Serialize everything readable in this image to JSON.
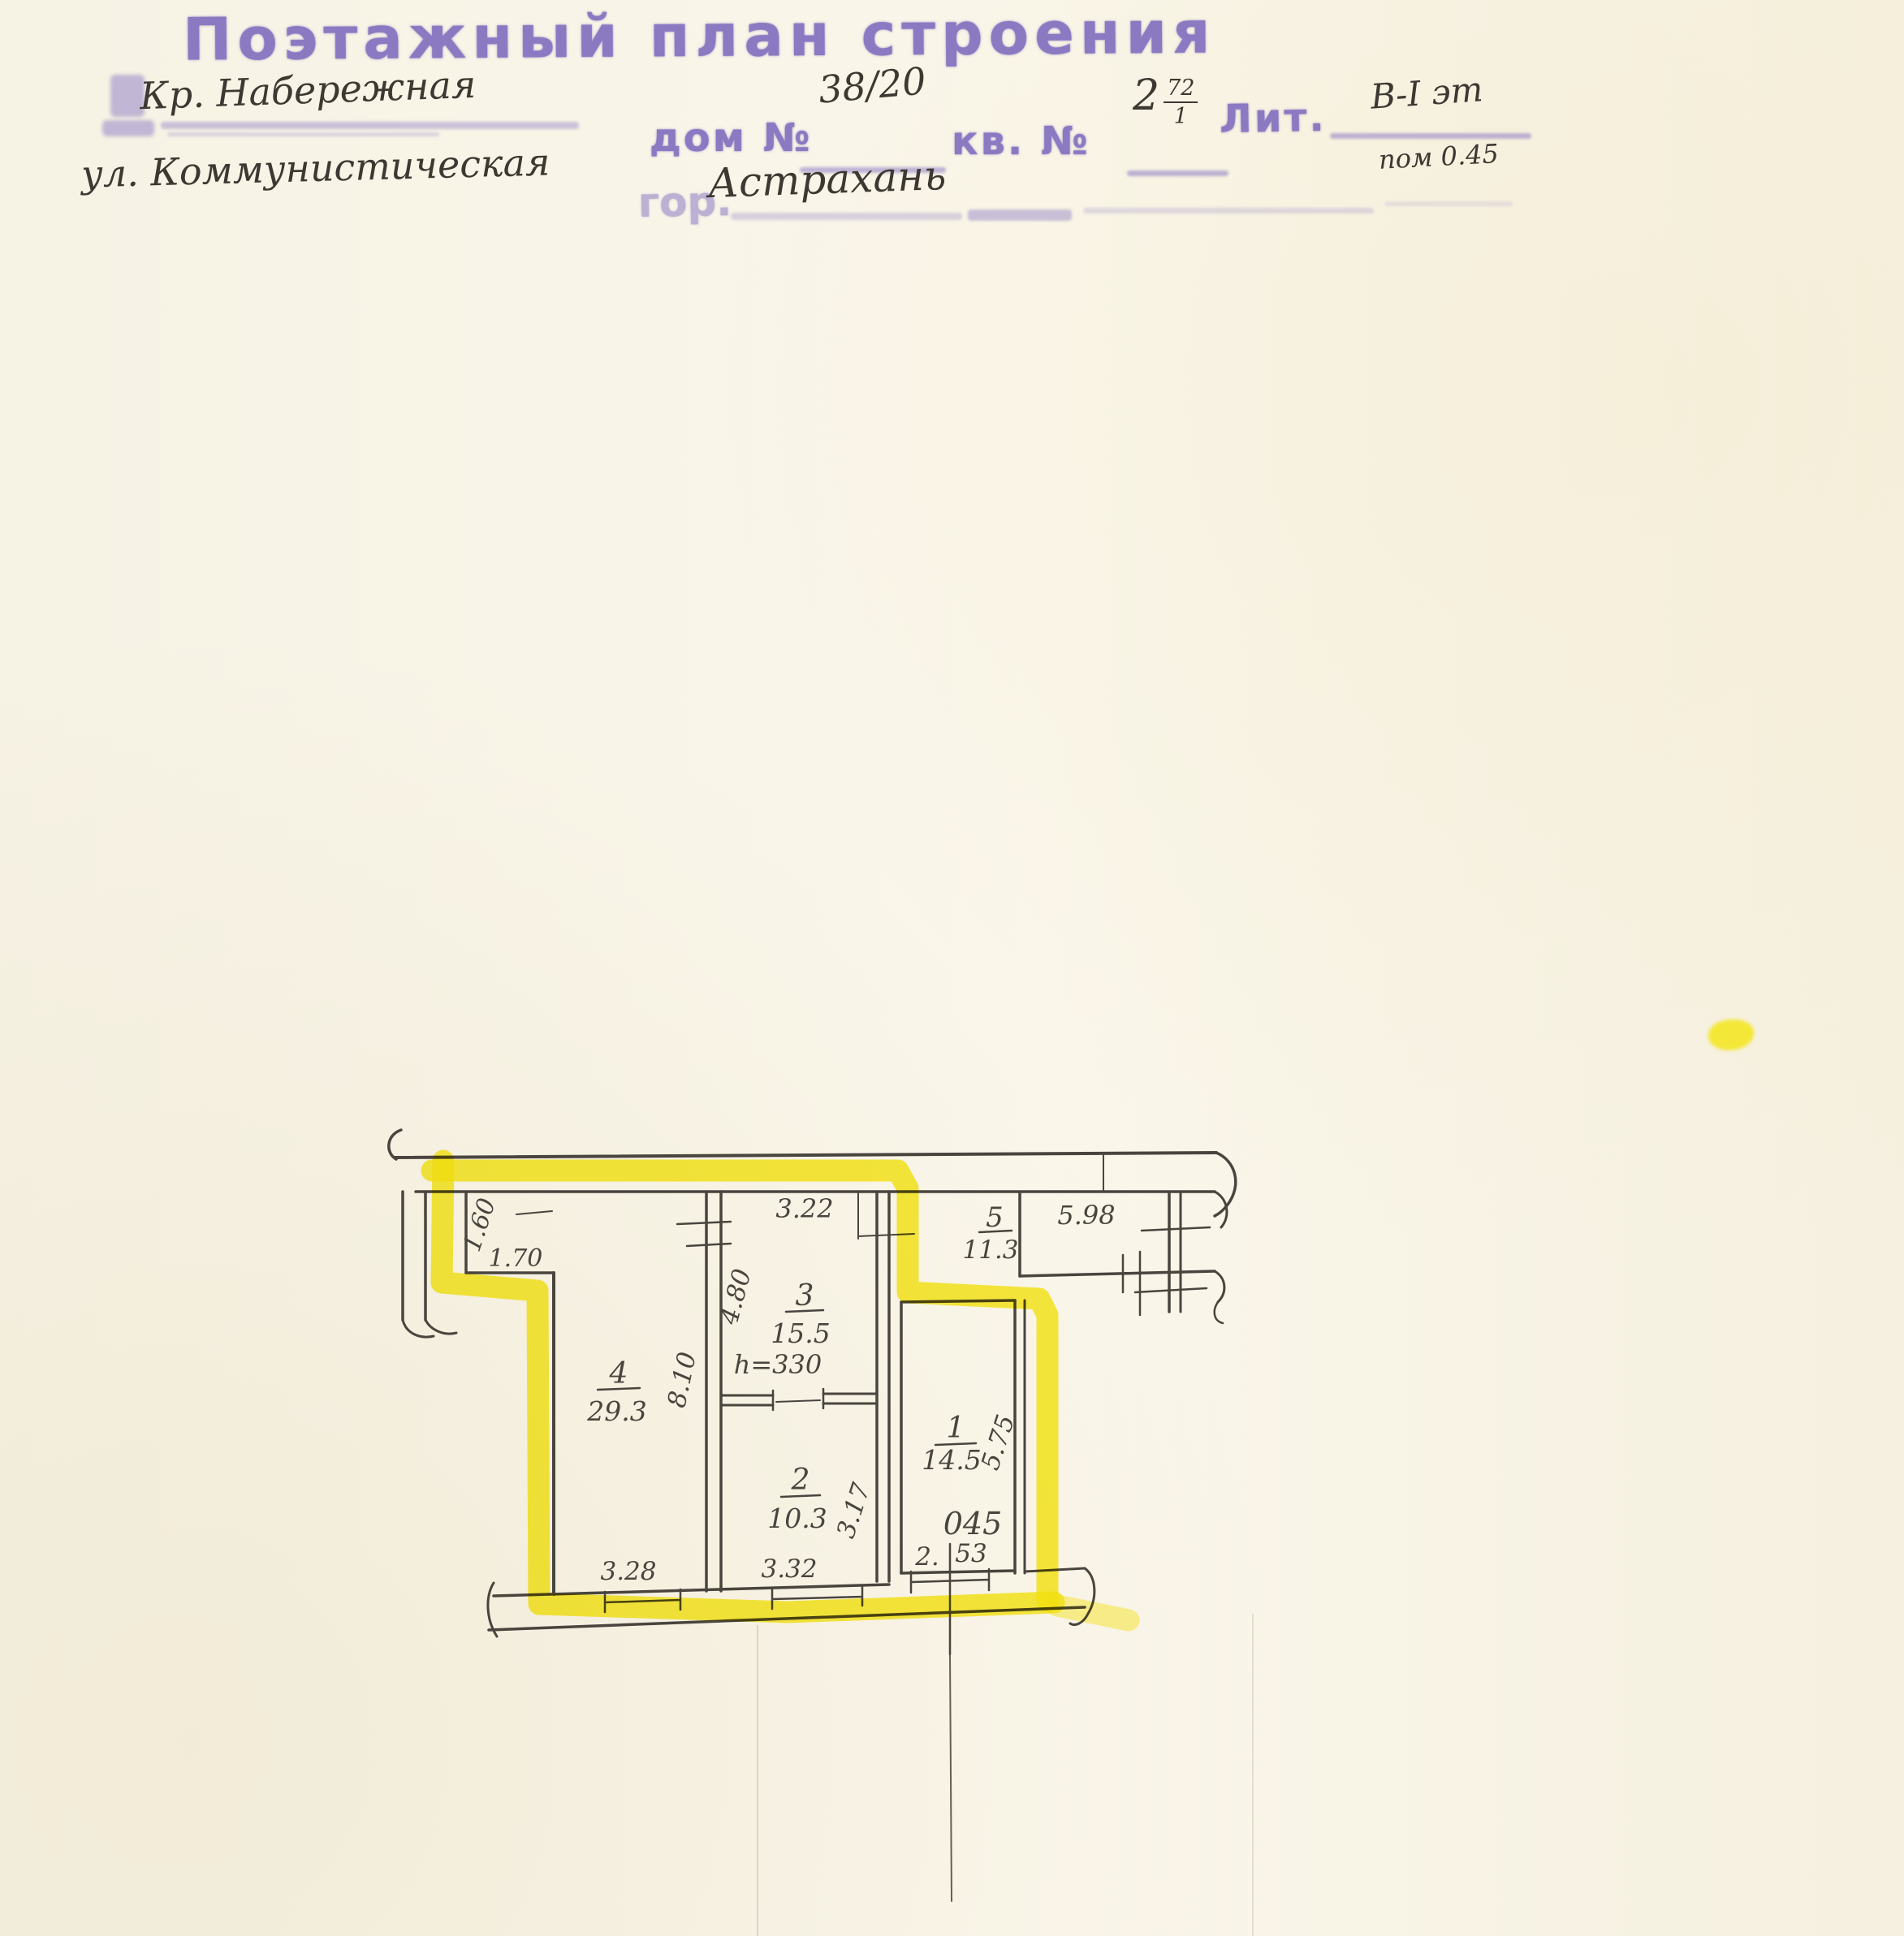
{
  "document": {
    "title": "Поэтажный план строения",
    "address_line_1": "Кр. Набережная",
    "address_line_2": "ул. Коммунистическая",
    "house_label": "дом №",
    "house_value": "38/20",
    "apartment_label": "кв. №",
    "apartment_value": "2",
    "apartment_fraction_top": "72",
    "apartment_fraction_bottom": "1",
    "liter_label": "Лит.",
    "liter_value": "В-I эт",
    "premise_note": "пом 0.45",
    "city_label": "гор.",
    "city_value": "Астрахань"
  },
  "plan": {
    "rooms": [
      {
        "no": "1",
        "area": "14.5"
      },
      {
        "no": "2",
        "area": "10.3"
      },
      {
        "no": "3",
        "area": "15.5"
      },
      {
        "no": "4",
        "area": "29.3"
      },
      {
        "no": "5",
        "area": "11.3"
      }
    ],
    "dims": {
      "alcove_height": "1.60",
      "alcove_width": "1.70",
      "room3_width": "3.22",
      "room3_depth": "4.80",
      "room4_depth": "8.10",
      "room2_depth": "3.17",
      "room4_width": "3.28",
      "room2_width": "3.32",
      "room1_width_a": "2.",
      "room1_width_b": "53",
      "room1_depth": "5.75",
      "room5_width": "5.98"
    },
    "ceiling_height_note": "h=330",
    "highlighted_unit_mark": "045"
  },
  "colors": {
    "stamp": "#8b7ac2",
    "ink": "#49453e",
    "handwriting": "#3d3831",
    "highlighter": "#f8ea14",
    "note_blue": "#2f55c0",
    "unit_red": "#e0364a",
    "paper": "#f9f5e9"
  }
}
